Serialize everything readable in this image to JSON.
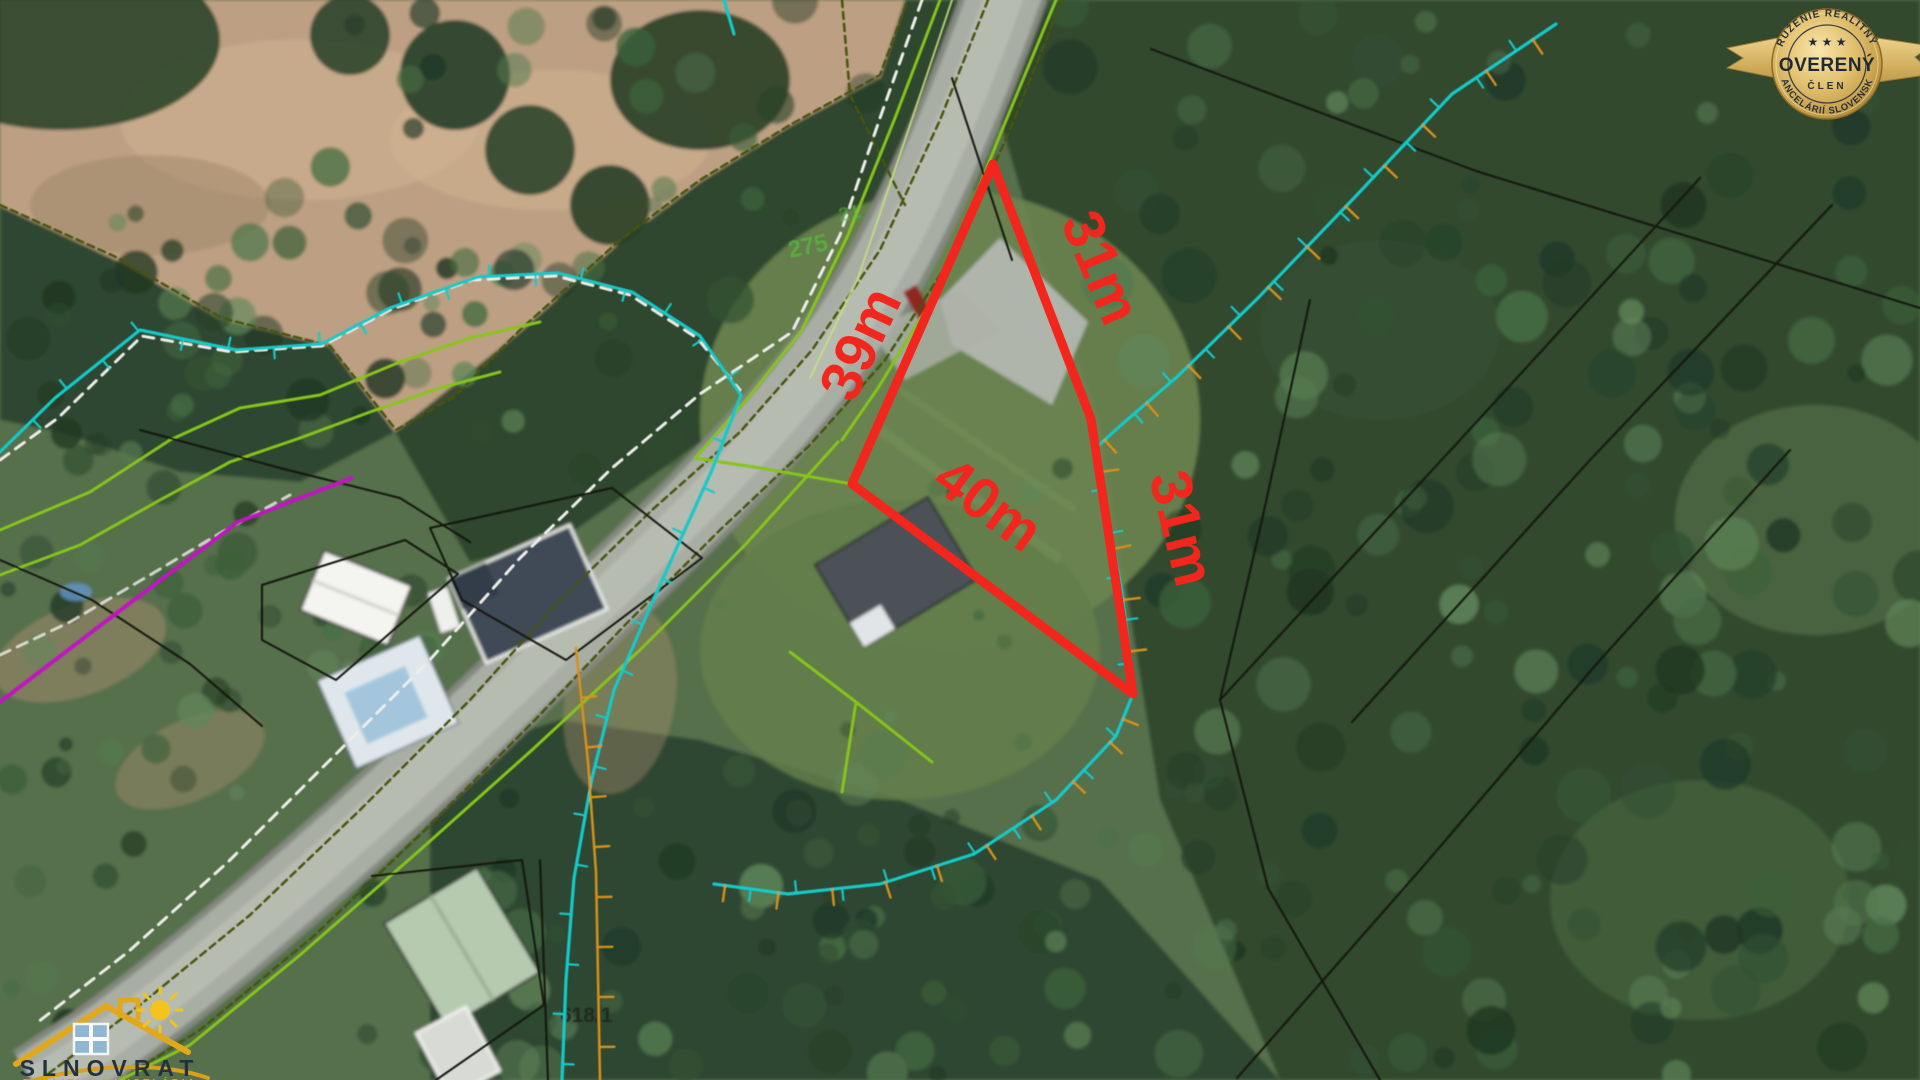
{
  "map": {
    "plot": {
      "outline_color": "#f2261c",
      "side_labels": {
        "left": "39m",
        "top_right": "31m",
        "right": "31m",
        "bottom": "40m"
      }
    },
    "parcel_numbers": {
      "near_road_top": "21",
      "near_road": "275",
      "bottom_center": "618/1"
    },
    "line_colors": {
      "utility_cyan": "#12c9c9",
      "utility_orange": "#d8911d",
      "boundary_white": "#ededea",
      "boundary_green": "#86c41c",
      "boundary_olive": "#46550c",
      "boundary_black": "#12160e",
      "boundary_magenta": "#c017c0"
    }
  },
  "badge": {
    "arc_top": "ZDRUŽENIE REALITNÝCH",
    "arc_bottom": "KANCELÁRIÍ SLOVENSKA",
    "stars": "★ ★ ★",
    "title": "OVERENÝ",
    "subtitle": "ČLEN",
    "gold": "#d2a855",
    "text_color": "#242e3b"
  },
  "logo": {
    "name": "SLNOVRAT",
    "tagline": "REALITNÁ KANCELÁRIA",
    "gold": "#e2a81c",
    "text_color": "#25323e"
  }
}
